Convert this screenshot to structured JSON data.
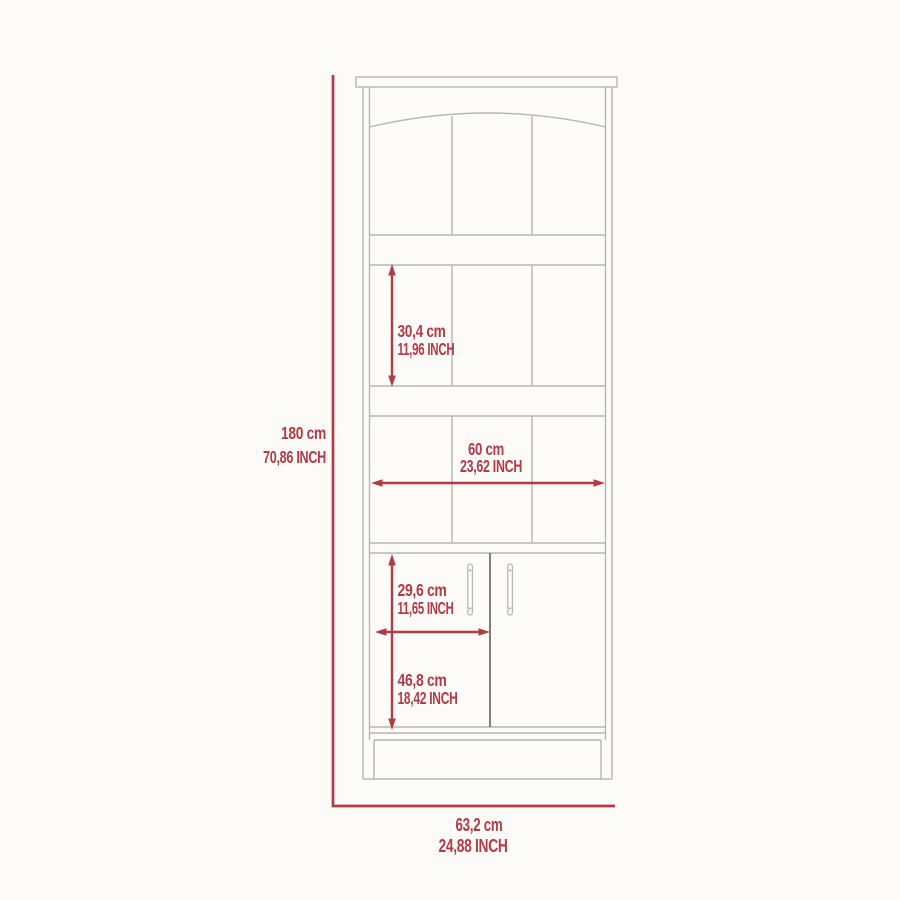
{
  "colors": {
    "dimension": "#b13b46",
    "outline": "#b7b6b3",
    "outline_dark": "#5f5f5d",
    "background": "#fcfbf8"
  },
  "chart_data": {
    "type": "table",
    "title": "",
    "note": "technical dimension drawing of a tall bookcase cabinet with lower two-door storage"
  },
  "dimensions": {
    "overall_height": {
      "cm": "180 cm",
      "inch": "70,86 INCH"
    },
    "shelf_section_height": {
      "cm": "30,4 cm",
      "inch": "11,96 INCH"
    },
    "interior_width": {
      "cm": "60 cm",
      "inch": "23,62 INCH"
    },
    "door_width": {
      "cm": "29,6 cm",
      "inch": "11,65 INCH"
    },
    "door_height": {
      "cm": "46,8 cm",
      "inch": "18,42 INCH"
    },
    "overall_width": {
      "cm": "63,2 cm",
      "inch": "24,88 INCH"
    }
  }
}
